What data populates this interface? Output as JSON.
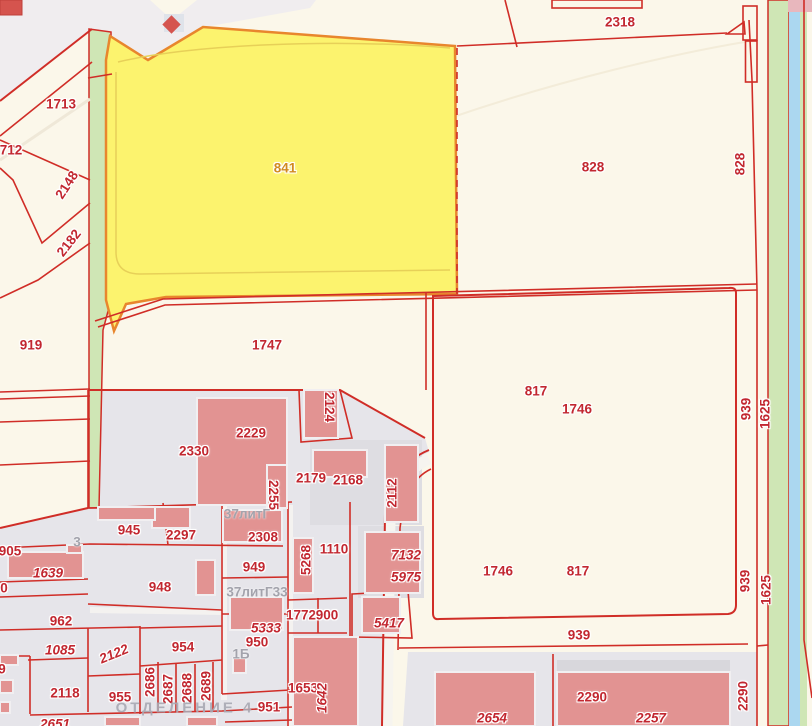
{
  "map": {
    "type": "cadastral parcel map",
    "highlighted_parcel": "841",
    "colors": {
      "background": "#fbf7ea",
      "built_area": "#f0edef",
      "industrial_zone": "#e6e5ea",
      "parcel_line": "#d02d27",
      "building_fill": "#e29392",
      "highlight_parcel_fill": "#fcf36e",
      "highlight_parcel_border": "#e8862d",
      "label_red": "#c22730",
      "label_orange": "#d18a20",
      "label_grey": "#a3a3ac",
      "green_strip": "#cfe6b5",
      "water_strip": "#abd7f0"
    },
    "labels": [
      {
        "text": "2318",
        "x": 620,
        "y": 22
      },
      {
        "text": "1713",
        "x": 61,
        "y": 104
      },
      {
        "text": "712",
        "x": 11,
        "y": 150
      },
      {
        "text": "2148",
        "x": 67,
        "y": 185,
        "rot": -57
      },
      {
        "text": "2182",
        "x": 69,
        "y": 243,
        "rot": -52
      },
      {
        "text": "919",
        "x": 31,
        "y": 345
      },
      {
        "text": "841",
        "x": 285,
        "y": 168,
        "kind": "orange"
      },
      {
        "text": "828",
        "x": 593,
        "y": 167
      },
      {
        "text": "828",
        "x": 740,
        "y": 164,
        "rot": -90
      },
      {
        "text": "1747",
        "x": 267,
        "y": 345
      },
      {
        "text": "817",
        "x": 536,
        "y": 391
      },
      {
        "text": "1746",
        "x": 577,
        "y": 409
      },
      {
        "text": "939",
        "x": 746,
        "y": 409,
        "rot": -90
      },
      {
        "text": "1625",
        "x": 765,
        "y": 414,
        "rot": -90
      },
      {
        "text": "2330",
        "x": 194,
        "y": 451
      },
      {
        "text": "2229",
        "x": 251,
        "y": 433
      },
      {
        "text": "2124",
        "x": 329,
        "y": 407,
        "rot": 90
      },
      {
        "text": "2179",
        "x": 311,
        "y": 478
      },
      {
        "text": "2168",
        "x": 348,
        "y": 480
      },
      {
        "text": "2255",
        "x": 273,
        "y": 495,
        "rot": 90
      },
      {
        "text": "2112",
        "x": 392,
        "y": 493,
        "rot": -90
      },
      {
        "text": "945",
        "x": 129,
        "y": 530
      },
      {
        "text": "2297",
        "x": 181,
        "y": 535
      },
      {
        "text": "2308",
        "x": 263,
        "y": 537
      },
      {
        "text": "949",
        "x": 254,
        "y": 567
      },
      {
        "text": "948",
        "x": 160,
        "y": 587
      },
      {
        "text": "5268",
        "x": 306,
        "y": 560,
        "rot": -90
      },
      {
        "text": "1110",
        "x": 334,
        "y": 549
      },
      {
        "text": "7132",
        "x": 406,
        "y": 555,
        "italic": true
      },
      {
        "text": "5975",
        "x": 406,
        "y": 577,
        "italic": true
      },
      {
        "text": "905",
        "x": 10,
        "y": 551
      },
      {
        "text": "1639",
        "x": 48,
        "y": 573,
        "italic": true
      },
      {
        "text": "0",
        "x": 4,
        "y": 588
      },
      {
        "text": "962",
        "x": 61,
        "y": 621
      },
      {
        "text": "1085",
        "x": 60,
        "y": 650,
        "italic": true
      },
      {
        "text": "2122",
        "x": 114,
        "y": 654,
        "rot": -22,
        "italic": true
      },
      {
        "text": "954",
        "x": 183,
        "y": 647
      },
      {
        "text": "1772",
        "x": 301,
        "y": 615
      },
      {
        "text": "900",
        "x": 327,
        "y": 615
      },
      {
        "text": "5417",
        "x": 389,
        "y": 623,
        "italic": true
      },
      {
        "text": "5333",
        "x": 266,
        "y": 628,
        "italic": true
      },
      {
        "text": "950",
        "x": 257,
        "y": 642
      },
      {
        "text": "2118",
        "x": 65,
        "y": 693
      },
      {
        "text": "955",
        "x": 120,
        "y": 697
      },
      {
        "text": "2686",
        "x": 150,
        "y": 682,
        "rot": -90
      },
      {
        "text": "2687",
        "x": 168,
        "y": 689,
        "rot": -90
      },
      {
        "text": "2688",
        "x": 187,
        "y": 688,
        "rot": -90
      },
      {
        "text": "2689",
        "x": 206,
        "y": 686,
        "rot": -90
      },
      {
        "text": "951",
        "x": 269,
        "y": 707
      },
      {
        "text": "1653",
        "x": 303,
        "y": 688
      },
      {
        "text": "1642",
        "x": 322,
        "y": 698,
        "rot": -90,
        "italic": true
      },
      {
        "text": "1746",
        "x": 498,
        "y": 571
      },
      {
        "text": "817",
        "x": 578,
        "y": 571
      },
      {
        "text": "939",
        "x": 579,
        "y": 635
      },
      {
        "text": "939",
        "x": 745,
        "y": 581,
        "rot": -90
      },
      {
        "text": "1625",
        "x": 766,
        "y": 590,
        "rot": -90
      },
      {
        "text": "2654",
        "x": 492,
        "y": 718,
        "italic": true
      },
      {
        "text": "2290",
        "x": 592,
        "y": 697
      },
      {
        "text": "2257",
        "x": 651,
        "y": 718,
        "italic": true
      },
      {
        "text": "2290",
        "x": 743,
        "y": 696,
        "rot": -90
      },
      {
        "text": "2651",
        "x": 55,
        "y": 724,
        "italic": true
      },
      {
        "text": "9",
        "x": 2,
        "y": 669
      },
      {
        "text": "37литГ",
        "x": 247,
        "y": 514,
        "kind": "grey"
      },
      {
        "text": "37литГ33",
        "x": 257,
        "y": 592,
        "kind": "grey"
      },
      {
        "text": "1Б",
        "x": 241,
        "y": 654,
        "kind": "grey"
      },
      {
        "text": "3",
        "x": 77,
        "y": 542,
        "kind": "grey"
      },
      {
        "text": "ОТДЕЛЕНИЕ 4",
        "x": 185,
        "y": 708,
        "kind": "grey-big"
      }
    ]
  }
}
